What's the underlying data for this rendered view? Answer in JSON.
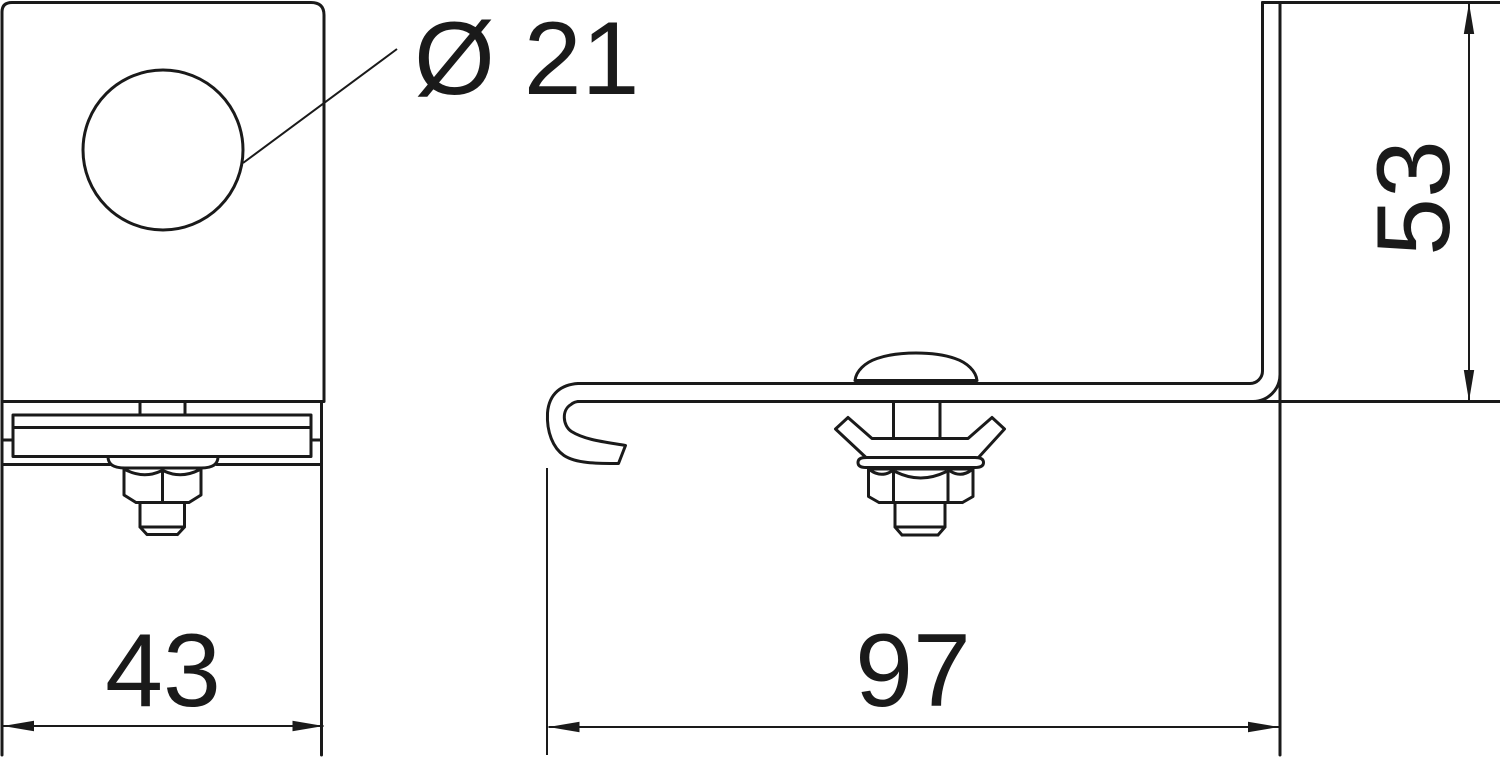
{
  "drawing": {
    "type": "technical-drawing-two-views",
    "views": {
      "front": {
        "hole_label": "Ø 21",
        "width_dim": "43"
      },
      "side": {
        "length_dim": "97",
        "height_dim": "53"
      }
    },
    "colors": {
      "line": "#1a1a1a",
      "background": "#ffffff"
    }
  }
}
